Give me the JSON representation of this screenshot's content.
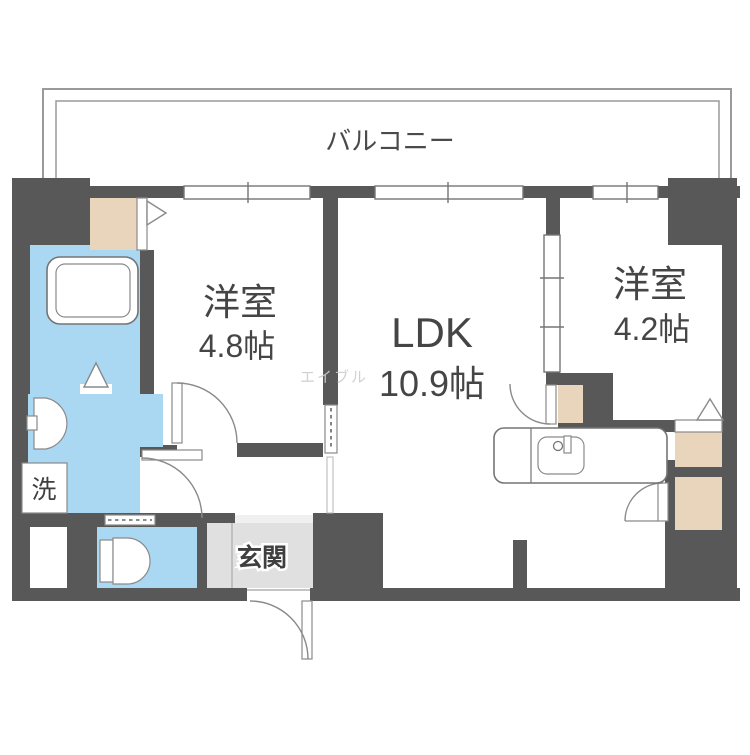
{
  "floorplan": {
    "balcony": {
      "label": "バルコニー"
    },
    "rooms": {
      "west_room": {
        "name": "洋室",
        "size": "4.8帖"
      },
      "ldk": {
        "name": "LDK",
        "size": "10.9帖"
      },
      "east_room": {
        "name": "洋室",
        "size": "4.2帖"
      },
      "entrance": {
        "label": "玄関"
      },
      "laundry": {
        "label": "洗"
      }
    },
    "watermark": "エイブル",
    "colors": {
      "wall": "#585858",
      "wet_area_floor": "#aad7f2",
      "closet": "#e9d5bb",
      "entrance_floor": "#e0e0e0"
    }
  }
}
